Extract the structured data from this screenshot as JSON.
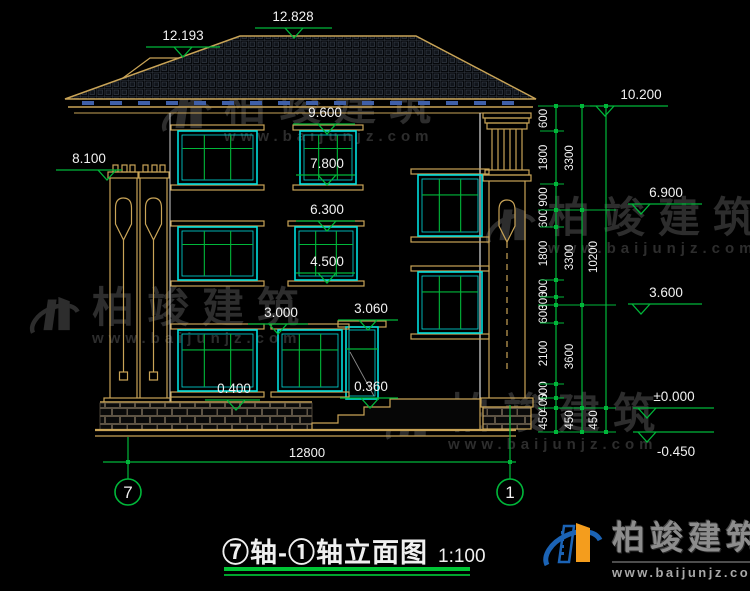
{
  "title": {
    "name": "⑦轴-①轴立面图",
    "scale": "1:100"
  },
  "axes": {
    "left": "7",
    "right": "1"
  },
  "dimensions": {
    "overall_width": "12800",
    "right_inner": [
      "600",
      "1800",
      "900",
      "600",
      "1800",
      "600",
      "300",
      "600",
      "2100",
      "500",
      "400",
      "450"
    ],
    "right_middle": [
      "3300",
      "3300",
      "3600",
      "450"
    ],
    "right_outer": [
      "10200",
      "450"
    ]
  },
  "elevations": {
    "ridge_main": "12.828",
    "ridge_secondary": "12.193",
    "eave": "10.200",
    "porch_top": "8.100",
    "w3_top": "9.600",
    "w3_sill": "7.800",
    "stair_upper": "6.900",
    "w2_top": "6.300",
    "w2_sill": "4.500",
    "floor2": "3.600",
    "w1_top": "3.000",
    "door_top": "3.060",
    "plinth_top": "0.400",
    "door_sill": "0.360",
    "ground": "±0.000",
    "site": "-0.450"
  },
  "watermark": {
    "brand": "柏竣建筑",
    "site": "www.baijunjz.com"
  },
  "logo": {
    "brand": "柏竣建筑",
    "site": "www.baijunjz.com"
  },
  "colors": {
    "green": "#00b73a",
    "tan": "#c9a457",
    "cyan": "#00dede",
    "white": "#f2f2f2",
    "blue_dash": "#3f5fa8",
    "stone": "#5d5344",
    "accent_blue": "#1b63b5",
    "accent_orange": "#f49d1d"
  }
}
